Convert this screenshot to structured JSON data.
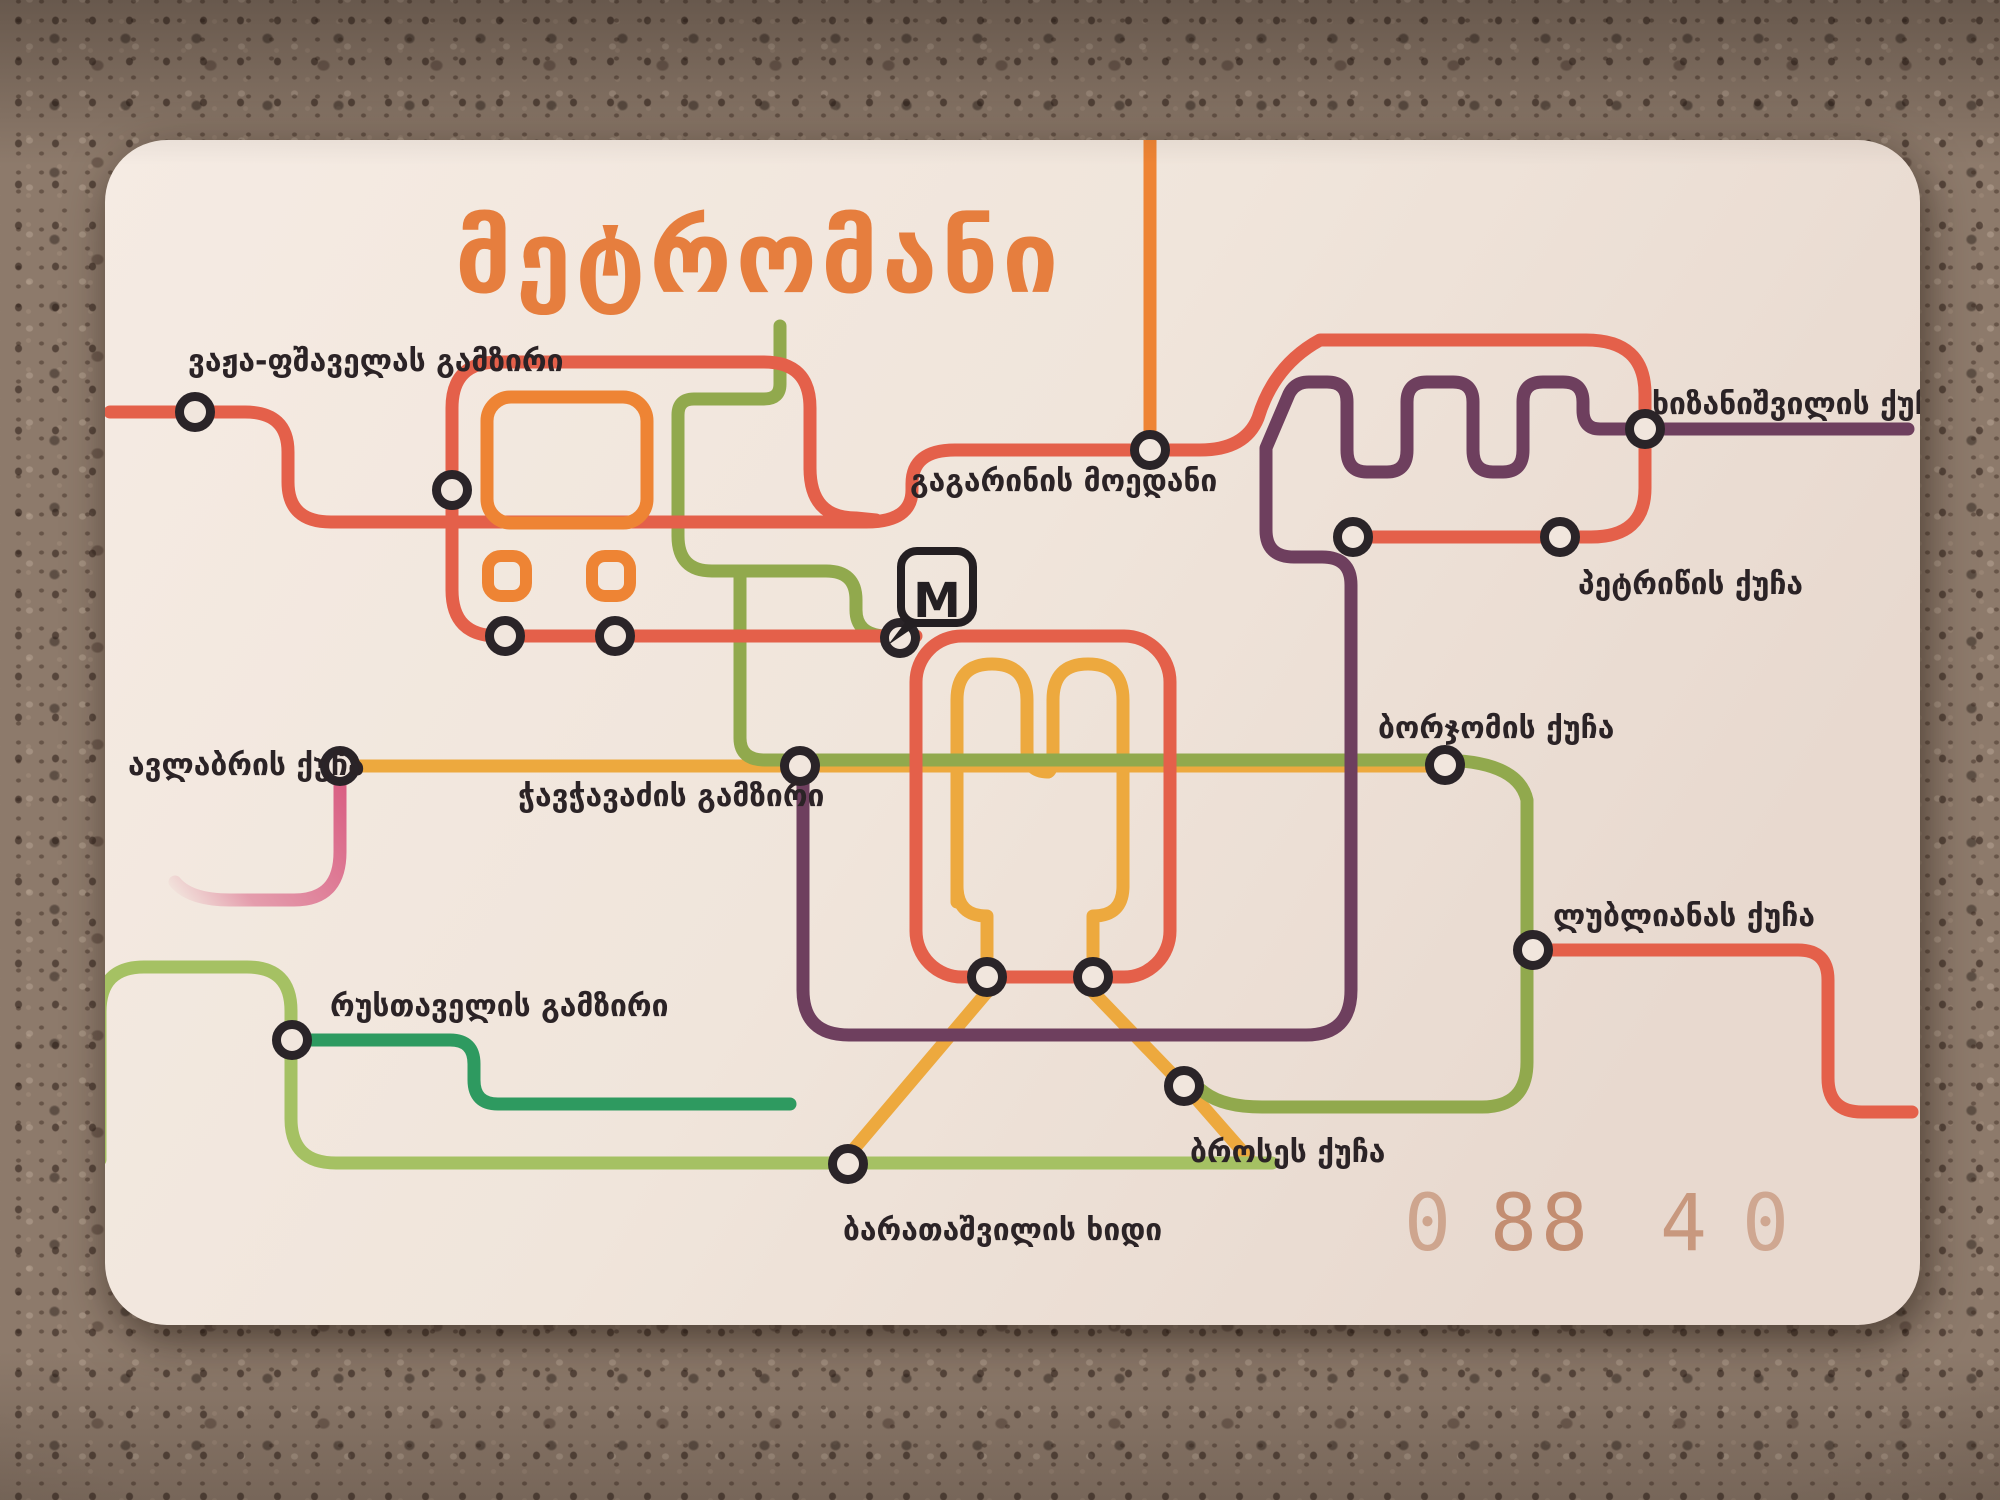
{
  "card": {
    "title": "მეტრომანი",
    "logo_letter": "M",
    "serial": {
      "full": "0 88 4 0",
      "d1": "0",
      "d2": "88",
      "d3": "4",
      "d4": "0"
    },
    "stations": {
      "vazha": "ვაჟა-ფშაველას გამზირი",
      "gagarini": "გაგარინის მოედანი",
      "khizanishvili": "ხიზანიშვილის ქუჩა",
      "petritsi": "პეტრიწის ქუჩა",
      "avlabari": "ავლაბრის ქუჩა",
      "chavchavadze": "ჭავჭავაძის გამზირი",
      "borjomi": "ბორჯომის ქუჩა",
      "ljubljana": "ლუბლიანას ქუჩა",
      "rustaveli": "რუსთაველის გამზირი",
      "brosse": "ბროსეს ქუჩა",
      "baratashvili": "ბარათაშვილის ხიდი"
    },
    "colors": {
      "title": "#e67e3e",
      "salmon": "#e4604a",
      "orange": "#ee8434",
      "amber": "#eda93e",
      "olive": "#91a94d",
      "light_green": "#a5c163",
      "teal": "#2e9a60",
      "purple": "#6e3f5e",
      "pink": "#d95f83",
      "station_ring": "#2a2428",
      "label": "#2b2326",
      "serial_color": "#b5714e",
      "card_bg": "#f1e6dd",
      "logo_ink": "#241f22"
    }
  }
}
